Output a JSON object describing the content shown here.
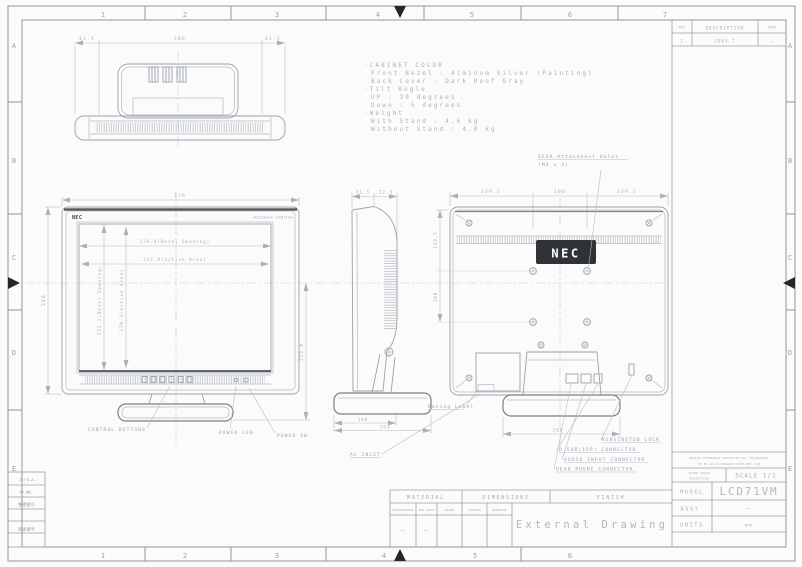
{
  "sheet": {
    "cols": [
      "1",
      "2",
      "3",
      "4",
      "5",
      "6",
      "7"
    ],
    "rows": [
      "A",
      "B",
      "C",
      "D",
      "E"
    ]
  },
  "revision": {
    "rev_h": "REV",
    "desc_h": "DESCRIPTION",
    "appd_h": "APPD",
    "rev": "1",
    "desc": "2003.7",
    "appd": "—"
  },
  "notes": {
    "l1": "·CABINET COLOR",
    "l2": "Front Bezel : Alminum Silver (Painting)",
    "l3": "Back Cover : Dark Roof Gray",
    "l4": "·Tilt Angle",
    "l5": "UP : 30 degrees",
    "l6": "Down : 5 degrees",
    "l7": "·Weight",
    "l8": "With Stand : 4.6 kg",
    "l9": "Without Stand : 4.0 kg"
  },
  "top_view": {
    "dim_left": "41.5",
    "dim_center": "286",
    "dim_right": "41.5"
  },
  "front": {
    "brand": "NEC",
    "badge": "AccuSync LCD71vm",
    "dim_width": "379",
    "dim_height": "340",
    "bezel_w": "339.8(Bezel Opening)",
    "active_w": "337.9(Active Area)",
    "bezel_h": "272.2(Bezel Opening)",
    "active_h": "270.3(Active Area)",
    "dim_right": "223.9",
    "label_controls": "CONTROL BUTTONS",
    "label_led": "POWER LED",
    "label_sw": "POWER SW"
  },
  "side": {
    "dim_top1": "31.5",
    "dim_top2": "22.5",
    "dim_bot1": "108",
    "dim_bot2": "193",
    "label_rating": "Rating Label",
    "label_ac": "AC INLET"
  },
  "rear": {
    "brand": "NEC",
    "dim_t1": "139.5",
    "dim_t2": "100",
    "dim_t3": "139.5",
    "dim_l1": "139.5",
    "dim_l2": "100",
    "dim_base": "200",
    "vesa1": "VESA Attachment Holes",
    "vesa2": "(M4 x 4)",
    "label_kensington": "KENSINGTON LOCK",
    "label_dsub": "D-SUB(15P) CONNECTOR",
    "label_audio": "AUDIO INPUT CONNECTOR",
    "label_phone": "HEAD PHONE CONNECTOR"
  },
  "title_block": {
    "tol1": "UNLESS OTHERWISE SPECIFIED ALL TOLERANCES",
    "tol2": "TO BE IN ACCORDANCE WITH NEC STD",
    "proj1": "THIRD ANGLE",
    "proj2": "PROJECTION",
    "scale": "SCALE 1/1",
    "model_h": "MODEL",
    "model": "LCD71VM",
    "assy_h": "ASSY",
    "assy": "—",
    "units_h": "UNITS",
    "units": "mm"
  },
  "bottom_block": {
    "material": "MATERIAL",
    "dimensions": "DIMENSIONS",
    "finish": "FINISH",
    "s1": "ENGINEERING",
    "s2": "ENG APPD",
    "s3": "DRAWN",
    "s4": "CHECKED",
    "s5": "APPROVED",
    "d1": "—",
    "d2": "—",
    "title": "External Drawing"
  },
  "film_block": {
    "r1": "フィルム",
    "r2": "AP 無し",
    "r3": "整理番号",
    "r5": "図面番号"
  }
}
